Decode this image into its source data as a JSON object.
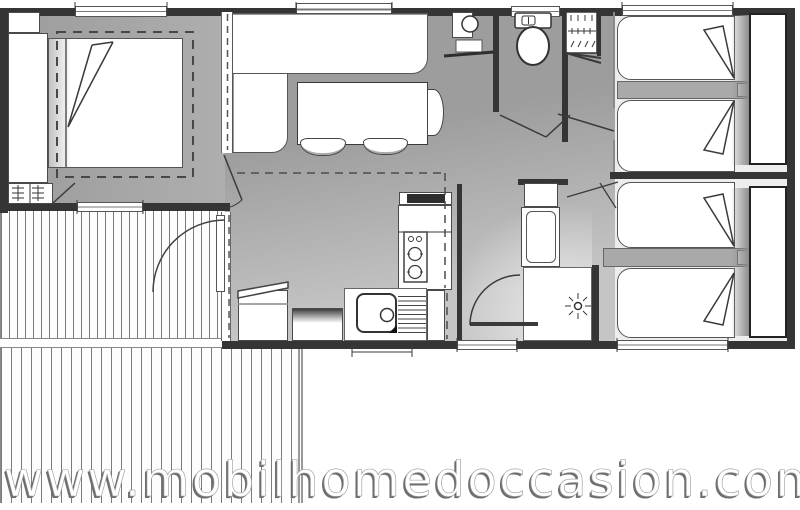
{
  "watermark": {
    "text": "www.mobilhomedoccasion.com"
  },
  "colors": {
    "wall": "#353535",
    "floor_gray": "#a0a0a0",
    "floor_light": "#c5c5c5",
    "bedroom_floor": "#ededed",
    "deck_line": "#7b7b7b",
    "outline": "#4a4a4a",
    "watermark_fill": "#ffffff",
    "watermark_shadow": "#6e6e6e"
  },
  "plan": {
    "rooms": [
      "master-bedroom",
      "living-dining",
      "kitchen",
      "wc",
      "bathroom",
      "bedroom-2",
      "bedroom-3",
      "terrace"
    ],
    "furniture": [
      "double-bed",
      "wardrobe",
      "sofa-l-shape",
      "dining-table",
      "stools",
      "kitchen-hob",
      "sink-drainboard",
      "toilet",
      "hand-basin",
      "closet",
      "water-heater",
      "vanity-basin",
      "shower",
      "single-beds",
      "nightstands",
      "headboards",
      "deck-planks"
    ]
  }
}
